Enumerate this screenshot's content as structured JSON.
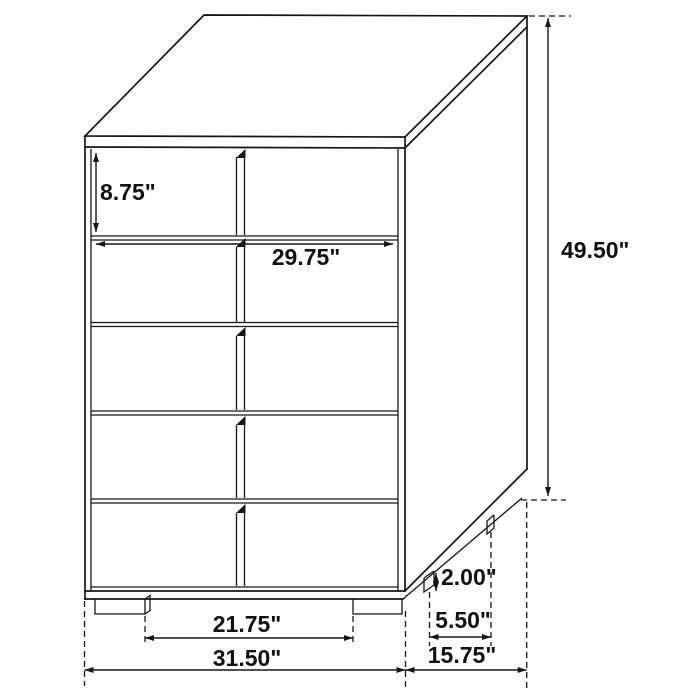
{
  "diagram": {
    "subject": "five-drawer-chest-dimension-drawing",
    "background_color": "#ffffff",
    "line_color": "#161616",
    "labels": {
      "drawer_height": "8.75\"",
      "drawer_width": "29.75\"",
      "overall_height": "49.50\"",
      "leg_height": "2.00\"",
      "side_leg_spacing": "5.50\"",
      "front_leg_spacing": "21.75\"",
      "overall_width": "31.50\"",
      "overall_depth": "15.75\""
    }
  }
}
